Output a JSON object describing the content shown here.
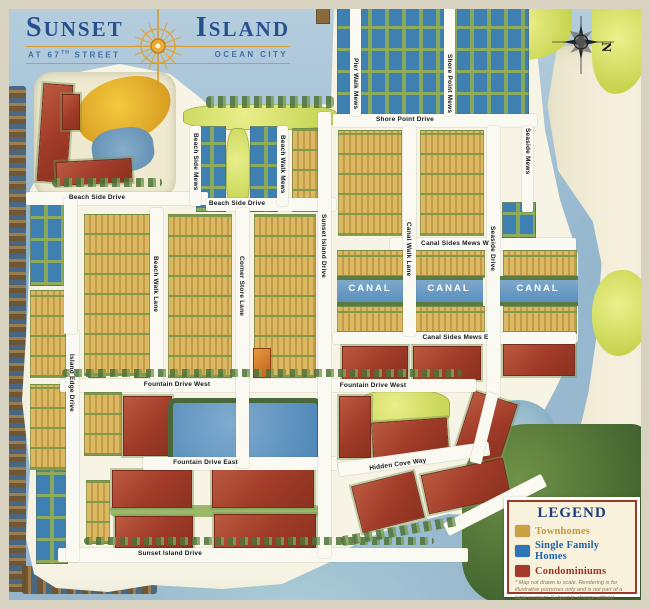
{
  "header": {
    "title_word1": "Sunset",
    "title_word2": "Island",
    "subtitle_street_prefix": "AT 67",
    "subtitle_street_sup": "TH",
    "subtitle_street_suffix": "STREET",
    "subtitle_city": "OCEAN CITY"
  },
  "compass": {
    "north_label": "N"
  },
  "streets": {
    "shore_point_drive": "Shore Point Drive",
    "pier_walk_mews": "Pier Walk Mews",
    "shore_point_mews": "Shore Point Mews",
    "seaside_mews": "Seaside Mews",
    "beach_side_drive_w": "Beach Side Drive",
    "beach_side_drive_e": "Beach Side Drive",
    "beach_side_mews": "Beach Side Mews",
    "beach_walk_mews": "Beach Walk Mews",
    "sunset_island_drive_n": "Sunset Island Drive",
    "beach_walk_lane": "Beach Walk Lane",
    "corner_store_lane": "Corner Store Lane",
    "canal_walk_lane": "Canal Walk Lane",
    "canal_sides_mews_w": "Canal Sides Mews W",
    "canal_sides_mews_e": "Canal Sides Mews E",
    "seaside_drive": "Seaside Drive",
    "island_edge_drive": "Island Edge Drive",
    "fountain_drive_west_1": "Fountain Drive West",
    "fountain_drive_west_2": "Fountain Drive West",
    "fountain_drive_east": "Fountain Drive East",
    "hidden_cove_way": "Hidden Cove Way",
    "sunset_island_drive_s": "Sunset Island Drive"
  },
  "water_labels": {
    "canal": "CANAL"
  },
  "legend": {
    "title": "LEGEND",
    "items": [
      {
        "label": "Townhomes",
        "color": "#c9a143",
        "text_color": "#c39a3e"
      },
      {
        "label": "Single Family Homes",
        "color": "#2d74b8",
        "text_color": "#1d64ae"
      },
      {
        "label": "Condominiums",
        "color": "#a63b2b",
        "text_color": "#9c3526"
      }
    ],
    "disclaimer": "* Map not drawn to scale. Rendering is for illustrative purposes only and is not part of a legal contract. Subject to change without notice or obligation."
  }
}
